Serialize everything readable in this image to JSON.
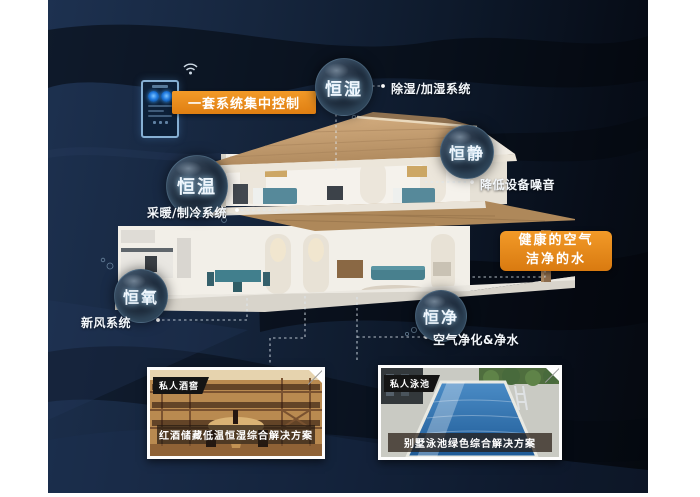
{
  "palette": {
    "background_navy": "#16263e",
    "band_dark": "#04070d",
    "accent_orange": "#ec8c1b",
    "bubble_rim": "#9ccbe9",
    "connector": "#e8eef4"
  },
  "control": {
    "label": "一套系统集中控制"
  },
  "features": [
    {
      "bubble": "恒湿",
      "label": "除湿/加湿系统"
    },
    {
      "bubble": "恒静",
      "label": "降低设备噪音"
    },
    {
      "bubble": "恒温",
      "label": "采暖/制冷系统"
    },
    {
      "bubble": "恒氧",
      "label": "新风系统"
    },
    {
      "bubble": "恒净",
      "label": "空气净化&净水"
    }
  ],
  "highlight_box": {
    "line1": "健康的空气",
    "line2": "洁净的水"
  },
  "cards": [
    {
      "tag": "私人酒窖",
      "caption": "红酒储藏低温恒湿综合解决方案"
    },
    {
      "tag": "私人泳池",
      "caption": "别墅泳池绿色综合解决方案"
    }
  ]
}
